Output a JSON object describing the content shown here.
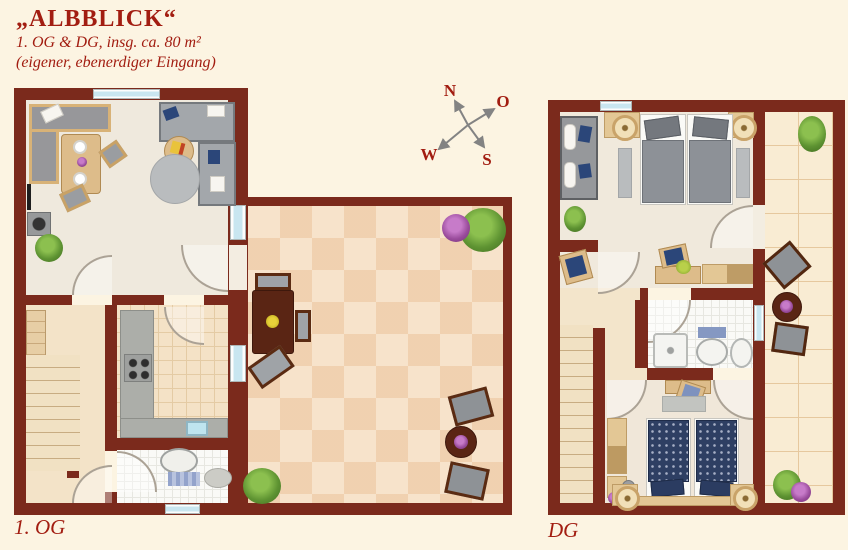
{
  "header": {
    "title": "„ALBBLICK“",
    "subtitle": "1. OG & DG, insg. ca. 80 m²",
    "note": "(eigener, ebenerdiger Eingang)"
  },
  "compass": {
    "n": "N",
    "o": "O",
    "s": "S",
    "w": "W"
  },
  "plans": {
    "og": {
      "label": "1. OG"
    },
    "dg": {
      "label": "DG"
    }
  },
  "colors": {
    "background": "#FCF4E2",
    "wall": "#7B2A1C",
    "accent_text": "#A21D11",
    "terrace_tile": "#F7E3CB",
    "window_glass": "#C9E6F0"
  }
}
